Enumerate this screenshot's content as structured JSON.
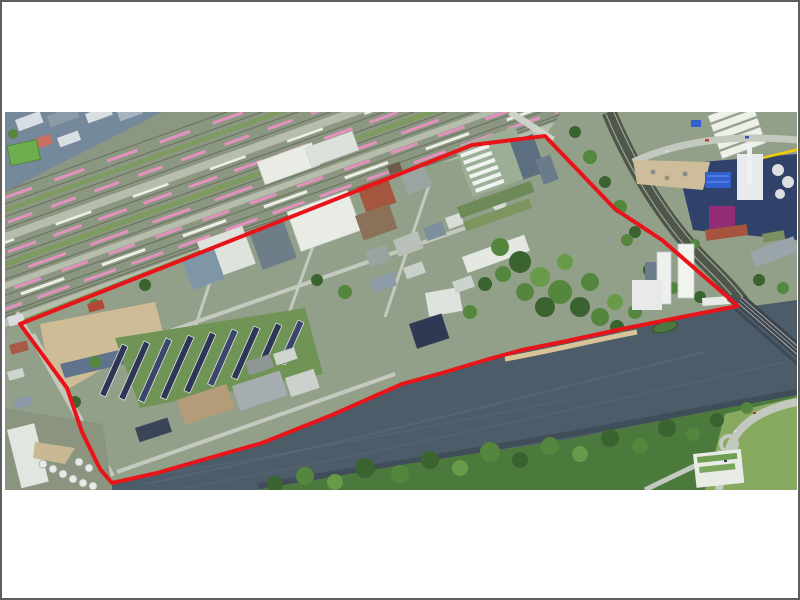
{
  "window": {
    "background": "#ffffff",
    "frame_color": "#5f5f5f"
  },
  "photo": {
    "content": "aerial-photograph-of-riverside-district-with-red-boundary-outline",
    "left": 3,
    "top": 110,
    "width": 792,
    "height": 378,
    "boundary": {
      "color": "#e8141a",
      "stroke_width": 4,
      "points": "15,212 397,61 467,33 540,24 610,97 657,128 733,194 677,205 617,217 557,230 517,238 484,247 437,261 397,272 327,303 257,331 197,348 152,361 107,371 95,357 77,320 62,276"
    },
    "palette": {
      "boundary_red": "#e8141a",
      "land": "#93a089",
      "rail_base": "#8c9781",
      "gravel": "#b7bdac",
      "track": "#6c7464",
      "river": "#4d5c69",
      "river_streak": "#5e6d7a",
      "water_shadow": "#39454f",
      "tree_dark": "#3a6330",
      "tree_mid": "#55863e",
      "tree_light": "#699a4a",
      "train_pink": "#e591bf",
      "train_white": "#eceee8",
      "roof_white": "#e9ebe5",
      "roof_gray": "#8d9ba6",
      "navy_complex": "#31426a",
      "purple_block": "#932d78",
      "industrial_blue": "#3261cf",
      "yard_tan": "#cdbd9a",
      "road": "#c4c9c0",
      "bridge_deck": "#3f454c",
      "beach": "#d8c398",
      "rowhouse_roof": "#2d3654",
      "garden_green": "#6f9455",
      "brownfield": "#cdbc96",
      "accent_yellow": "#f2cf00",
      "lawn": "#87aa60",
      "resi_base": "#76889c"
    }
  }
}
